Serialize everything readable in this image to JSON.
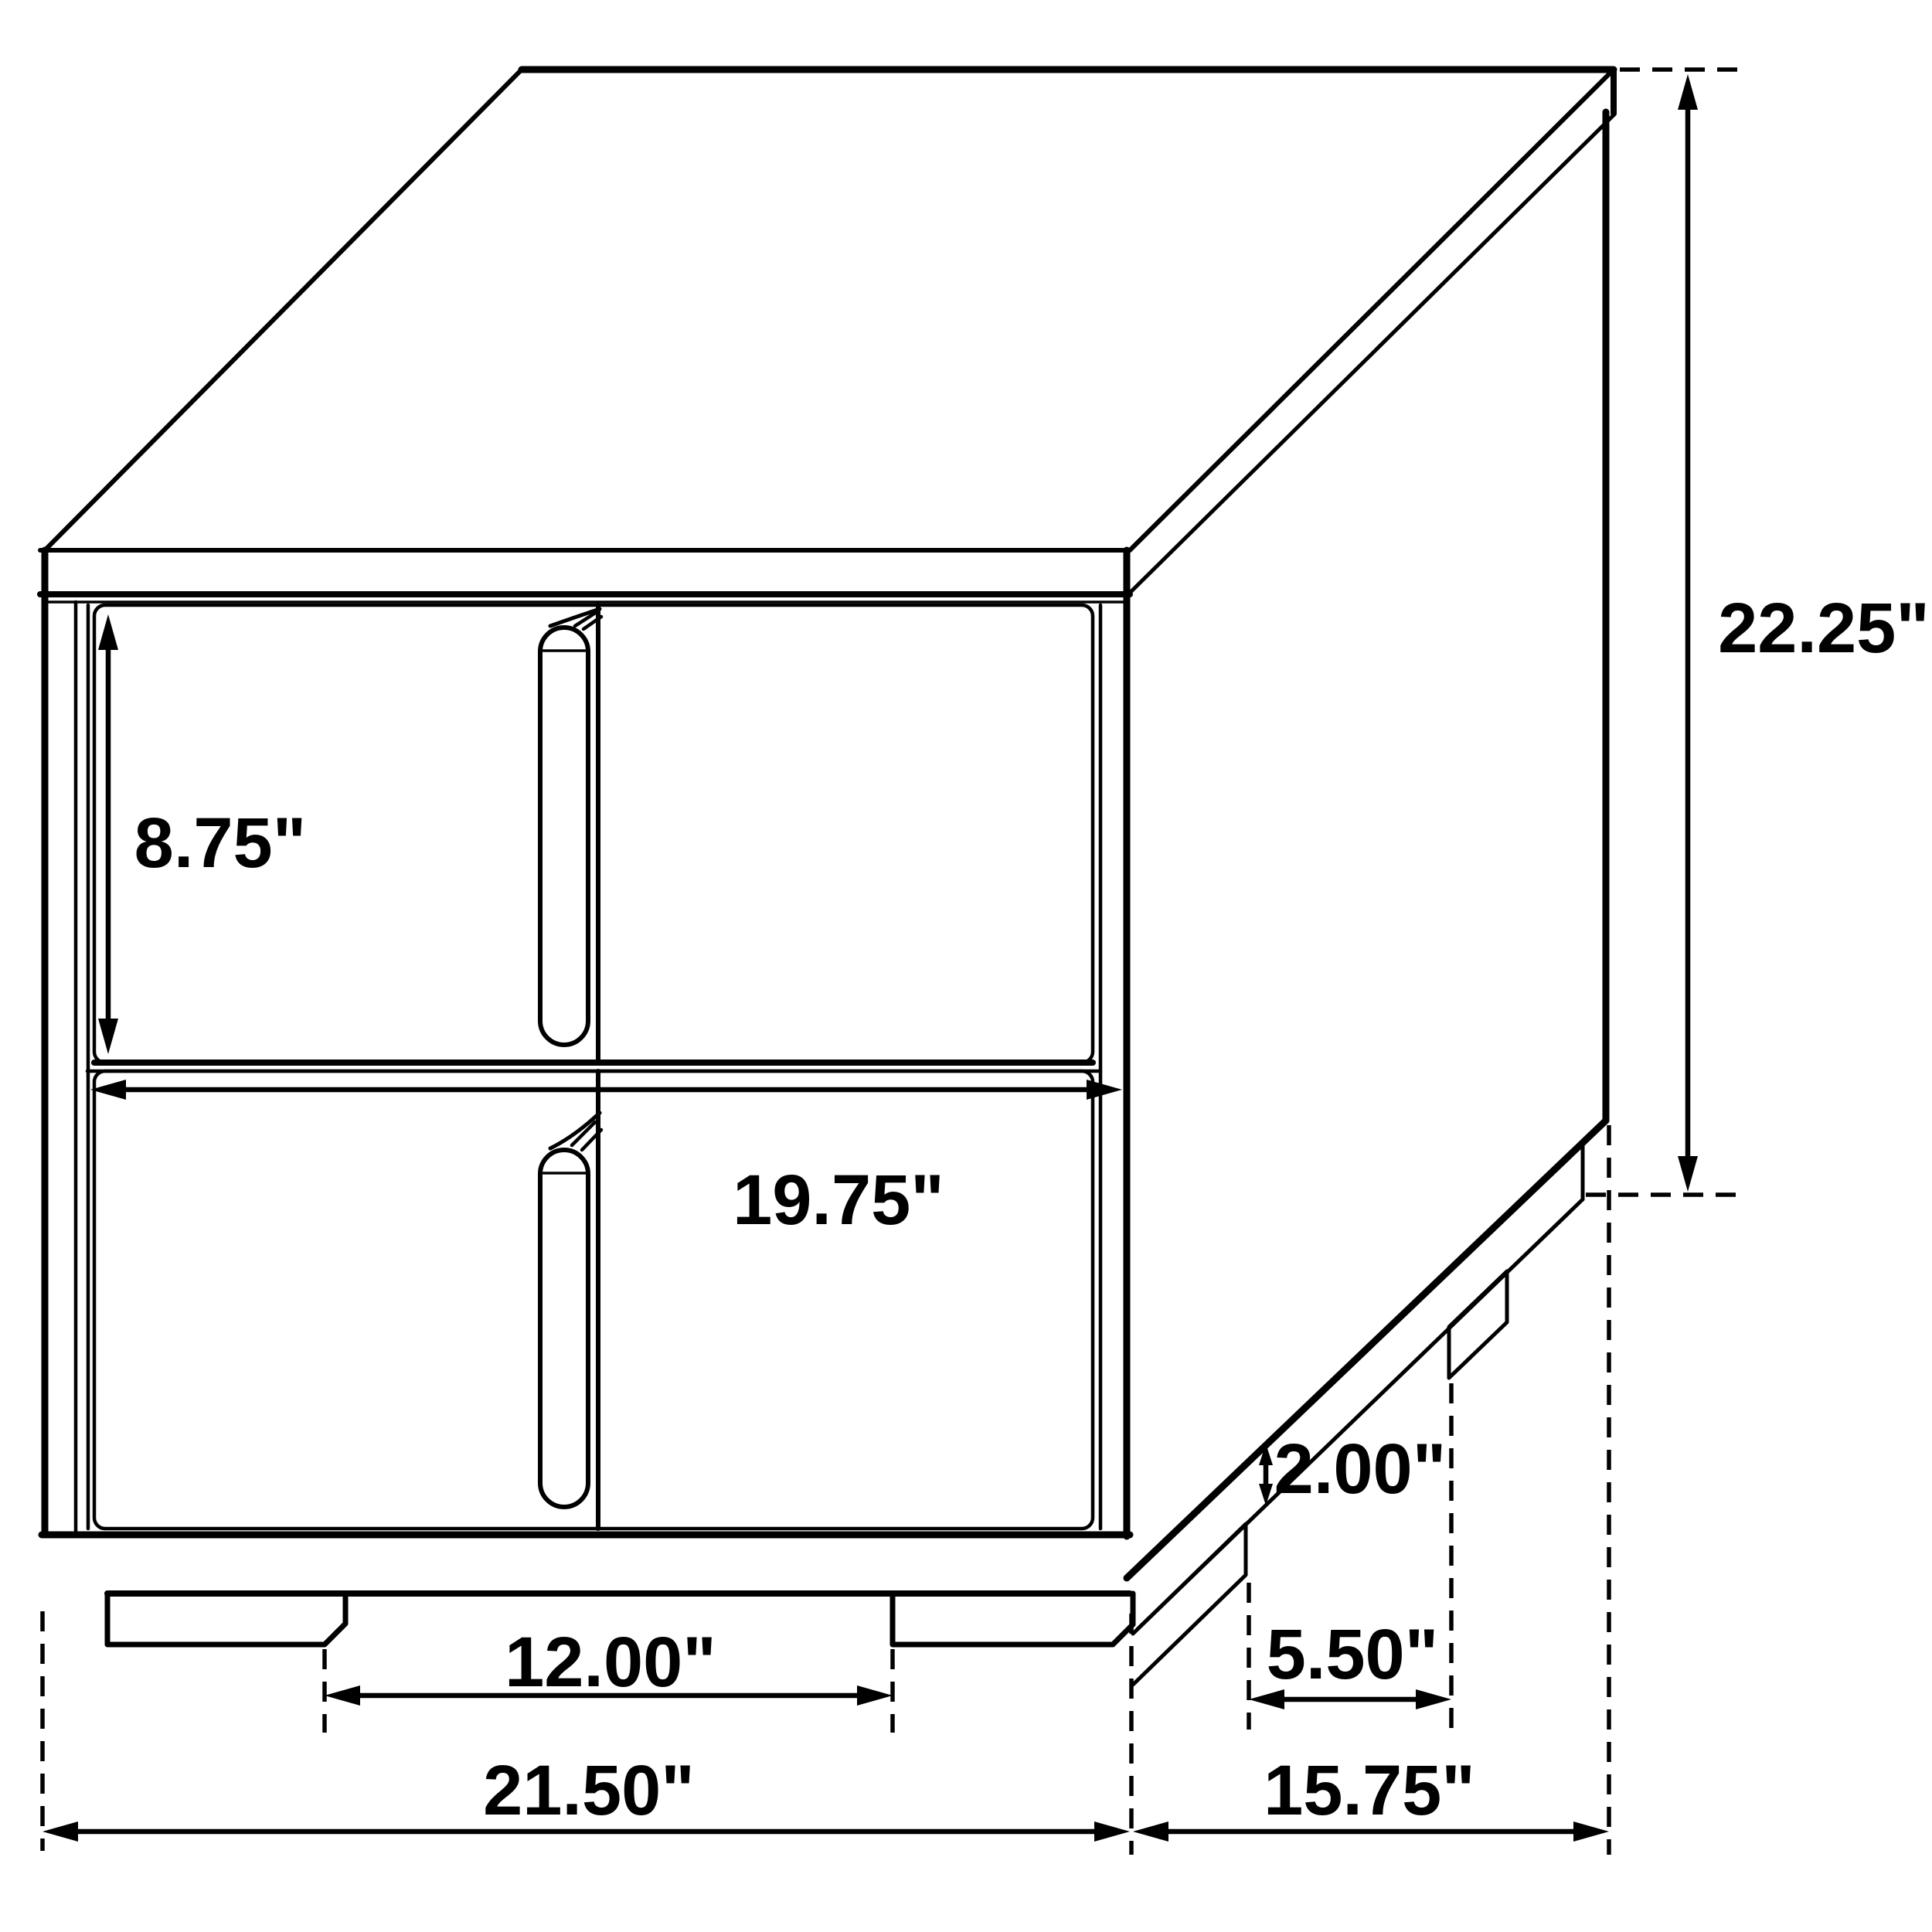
{
  "diagram": {
    "type": "furniture-dimension-drawing",
    "subject": "two-drawer nightstand isometric line drawing",
    "units": "inches",
    "colors": {
      "line": "#000000",
      "background": "#ffffff"
    },
    "labels": {
      "drawer_height": "8.75\"",
      "drawer_width": "19.75\"",
      "overall_height": "22.25\"",
      "base_height": "2.00\"",
      "front_leg_spacing": "12.00\"",
      "side_leg_spacing": "5.50\"",
      "overall_width": "21.50\"",
      "overall_depth": "15.75\""
    }
  }
}
